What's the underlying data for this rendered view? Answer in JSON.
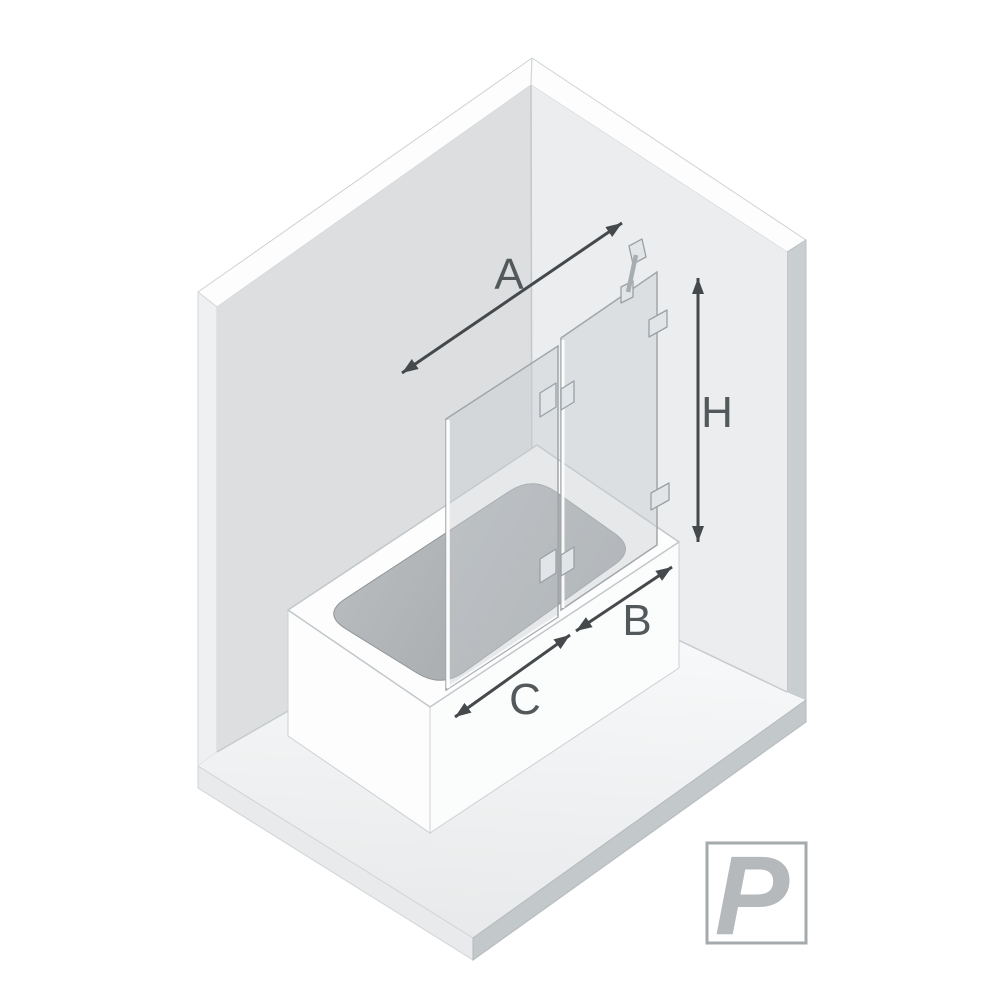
{
  "diagram": {
    "type": "isometric bath screen dimension diagram",
    "dimension_labels": {
      "total_width": "A",
      "fixed_panel_width": "B",
      "door_panel_width": "C",
      "height": "H"
    },
    "orientation_badge": {
      "letter": "P"
    }
  },
  "colors": {
    "background": "#ffffff",
    "left_wall": "#dcdee0",
    "right_wall": "#ebedee",
    "wall_top_edge": "#fdfdfd",
    "wall_side_left": "#eef0f1",
    "wall_side_right": "#c9ced1",
    "floor_near": "#fafbfc",
    "floor_far": "#e7e9ea",
    "slab_left": "#e8eaeb",
    "slab_right": "#c3c8ca",
    "tub_white": "#fdfdfe",
    "tub_front_right": "#fbfcfc",
    "basin_light": "#b9bcbe",
    "basin_dark": "#a0a4a6",
    "glass": "#c9ced2",
    "glass_edge": "#a0a6aa",
    "hardware": "#e2e5e7",
    "hardware_edge": "#9aa0a4",
    "edge_line": "#c6cbce",
    "arrow": "#45494c",
    "label_text": "#53585b",
    "badge_border": "#a5aaad",
    "badge_letter": "#b5b9bc"
  }
}
